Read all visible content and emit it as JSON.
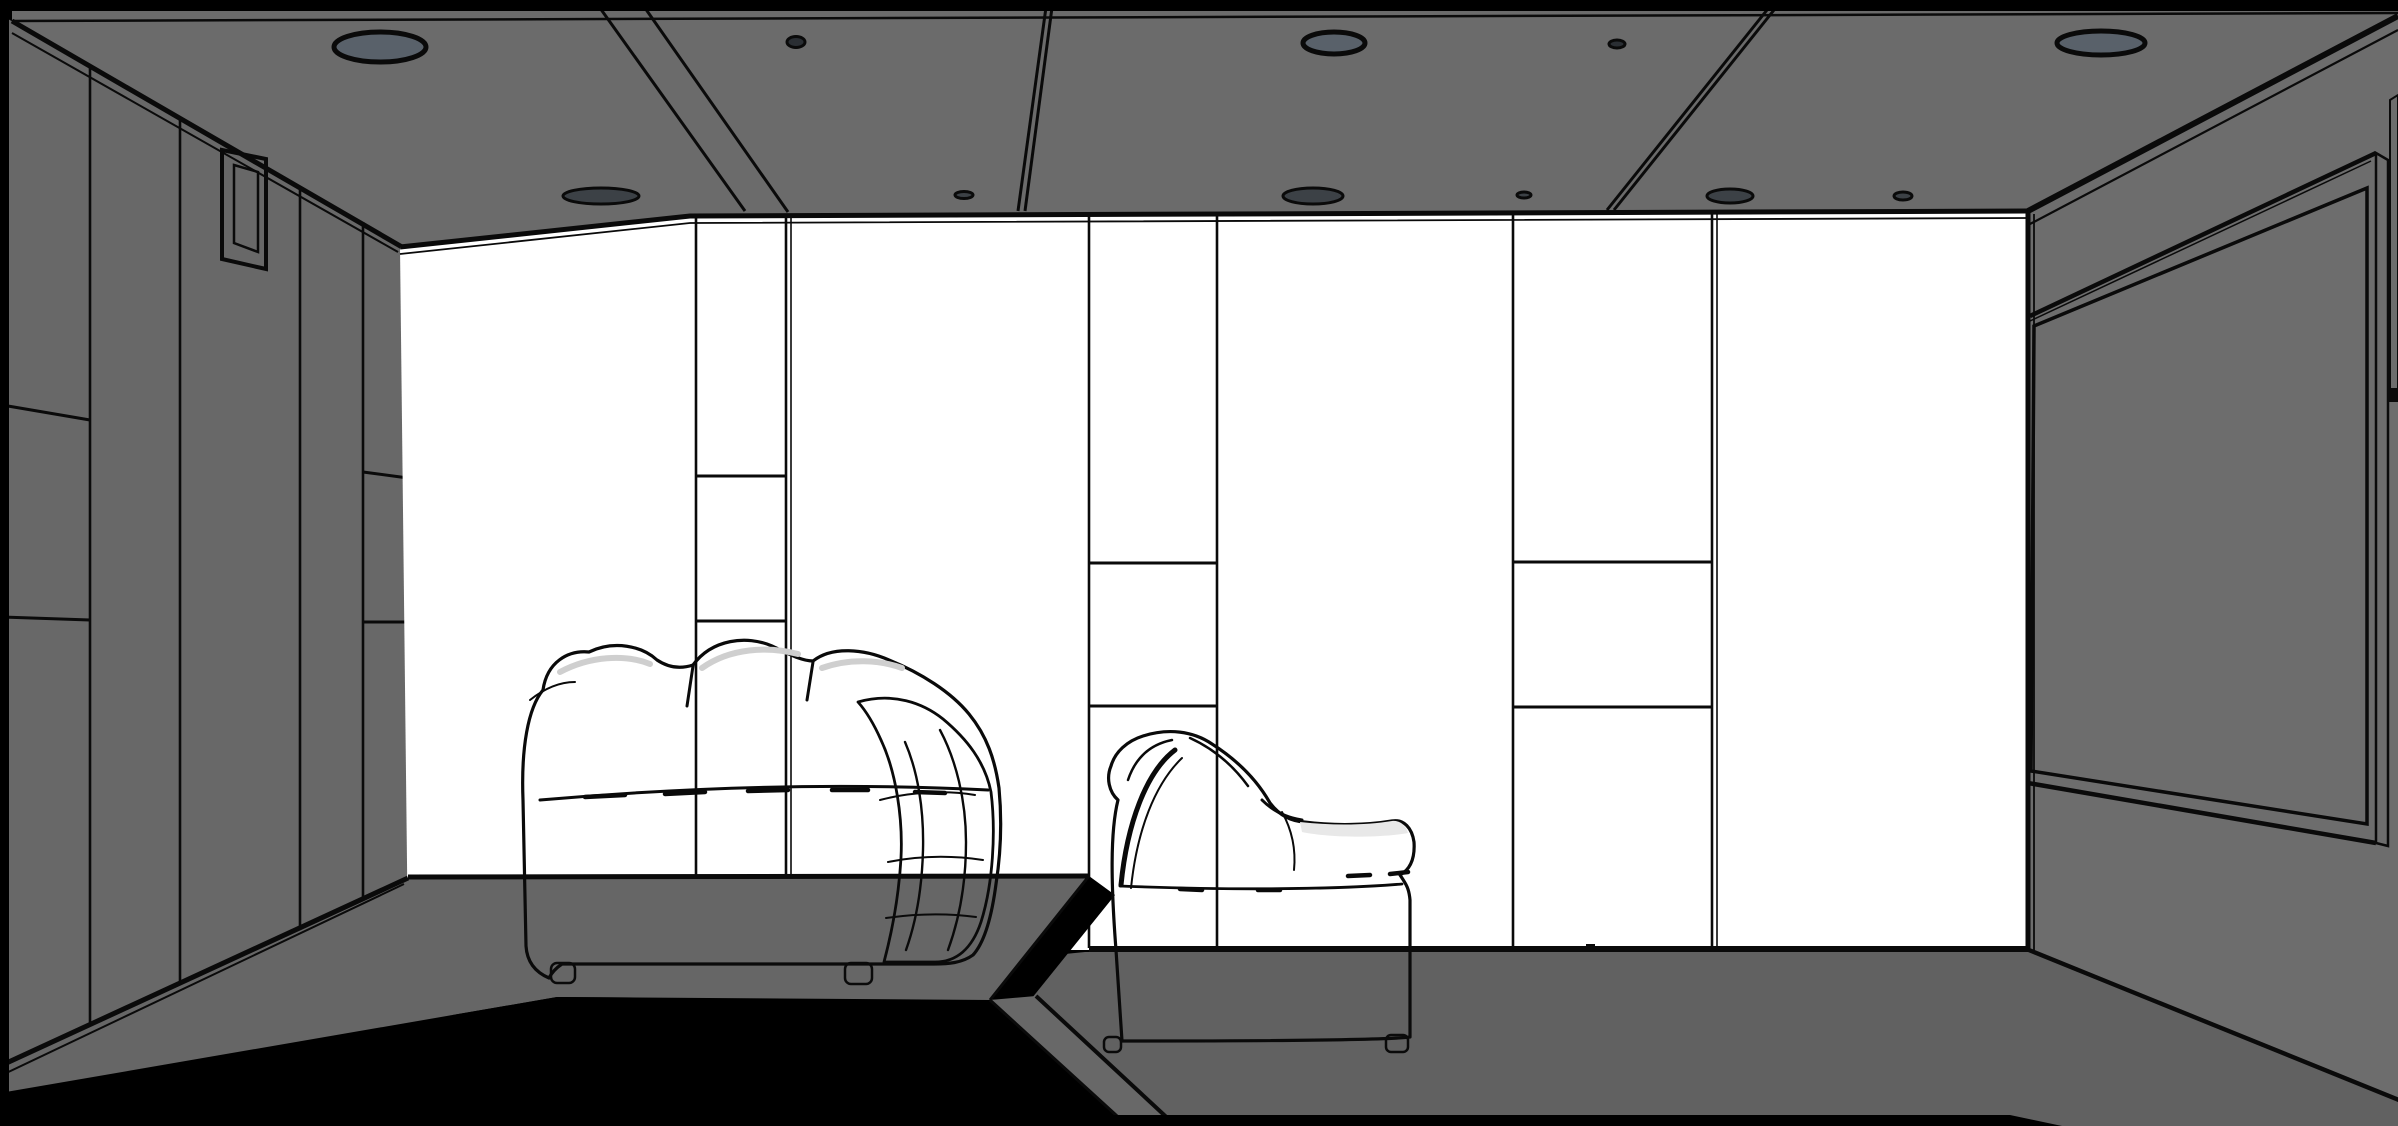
{
  "viewport": {
    "kind": "3d-room-line-render",
    "room": "home theater interior",
    "width": 2398,
    "height": 1126
  },
  "colors": {
    "background": "#000000",
    "line": "#0a0a0a",
    "ceiling": "#6b6b6b",
    "wall_left": "#686868",
    "wall_right": "#6d6d6d",
    "wall_back": "#ffffff",
    "floor": "#616161",
    "platform": "#666666",
    "step": "#686868",
    "screen_panel": "#676767",
    "screen_frame_light": "#f2f2f2",
    "skirting_light": "#f5f5f5",
    "light_large_fill": "#59616a",
    "light_small_fill": "#2a2e33",
    "light_edge_fill": "#3c4146",
    "sofa_fill": "#ffffff",
    "cushion_shade": "#9f9f9f",
    "crease_shade": "#cfcfcf",
    "seat_shade": "#e8e8e8",
    "window_frame": "#4a4a4a",
    "window_pane": "#fdfdfd"
  },
  "ceiling": {
    "lights": [
      {
        "kind": "large",
        "cx": 380,
        "cy": 47,
        "rx": 46,
        "ry": 15
      },
      {
        "kind": "large",
        "cx": 1334,
        "cy": 43,
        "rx": 31,
        "ry": 11
      },
      {
        "kind": "large",
        "cx": 2101,
        "cy": 43,
        "rx": 44,
        "ry": 12
      },
      {
        "kind": "small",
        "cx": 796,
        "cy": 42,
        "rx": 9,
        "ry": 5.5
      },
      {
        "kind": "small",
        "cx": 1617,
        "cy": 44,
        "rx": 8,
        "ry": 4
      },
      {
        "kind": "edge",
        "cx": 601,
        "cy": 196,
        "rx": 38,
        "ry": 8
      },
      {
        "kind": "edge",
        "cx": 964,
        "cy": 195,
        "rx": 9,
        "ry": 3.5
      },
      {
        "kind": "edge",
        "cx": 1313,
        "cy": 196,
        "rx": 30,
        "ry": 8
      },
      {
        "kind": "edge",
        "cx": 1524,
        "cy": 195,
        "rx": 7,
        "ry": 3
      },
      {
        "kind": "edge",
        "cx": 1730,
        "cy": 196,
        "rx": 23,
        "ry": 7
      },
      {
        "kind": "edge",
        "cx": 1903,
        "cy": 196,
        "rx": 9,
        "ry": 4
      }
    ],
    "seams": [
      {
        "x1": 600,
        "y1": 8,
        "x2": 745,
        "y2": 211
      },
      {
        "x1": 645,
        "y1": 8,
        "x2": 788,
        "y2": 212
      },
      {
        "x1": 1047,
        "y1": 0,
        "x2": 1018,
        "y2": 211
      },
      {
        "x1": 1053,
        "y1": 0,
        "x2": 1025,
        "y2": 211
      },
      {
        "x1": 1767,
        "y1": 10,
        "x2": 1607,
        "y2": 210
      },
      {
        "x1": 1774,
        "y1": 10,
        "x2": 1614,
        "y2": 210
      }
    ]
  },
  "walls": {
    "back": {
      "seams": [
        {
          "x": 696,
          "y1": 217,
          "y2": 875,
          "double": false
        },
        {
          "x": 786,
          "y1": 216,
          "y2": 875,
          "double": true
        },
        {
          "x": 1089,
          "y1": 214,
          "y2": 948,
          "double": false
        },
        {
          "x": 1217,
          "y1": 214,
          "y2": 948,
          "double": false
        },
        {
          "x": 1513,
          "y1": 212,
          "y2": 948,
          "double": false
        },
        {
          "x": 1712,
          "y1": 212,
          "y2": 948,
          "double": true
        }
      ],
      "dividers": [
        {
          "x1": 696,
          "x2": 786,
          "y": 476
        },
        {
          "x1": 696,
          "x2": 786,
          "y": 621
        },
        {
          "x1": 1089,
          "x2": 1217,
          "y": 563
        },
        {
          "x1": 1089,
          "x2": 1217,
          "y": 706
        },
        {
          "x1": 1513,
          "x2": 1712,
          "y": 562
        },
        {
          "x1": 1513,
          "x2": 1712,
          "y": 707
        }
      ]
    },
    "left": {
      "seams": [
        {
          "x": 90,
          "y1": 66,
          "y2": 1026
        },
        {
          "x": 180,
          "y1": 117,
          "y2": 984
        },
        {
          "x": 300,
          "y1": 186,
          "y2": 928
        },
        {
          "x": 363,
          "y1": 222,
          "y2": 899
        }
      ],
      "dividers": [
        {
          "x1": 2,
          "y1": 405,
          "x2": 90,
          "y2": 420
        },
        {
          "x1": 2,
          "y1": 617,
          "x2": 90,
          "y2": 620
        },
        {
          "x1": 363,
          "y1": 472,
          "x2": 408,
          "y2": 478
        },
        {
          "x1": 363,
          "y1": 622,
          "x2": 408,
          "y2": 622
        }
      ]
    }
  }
}
